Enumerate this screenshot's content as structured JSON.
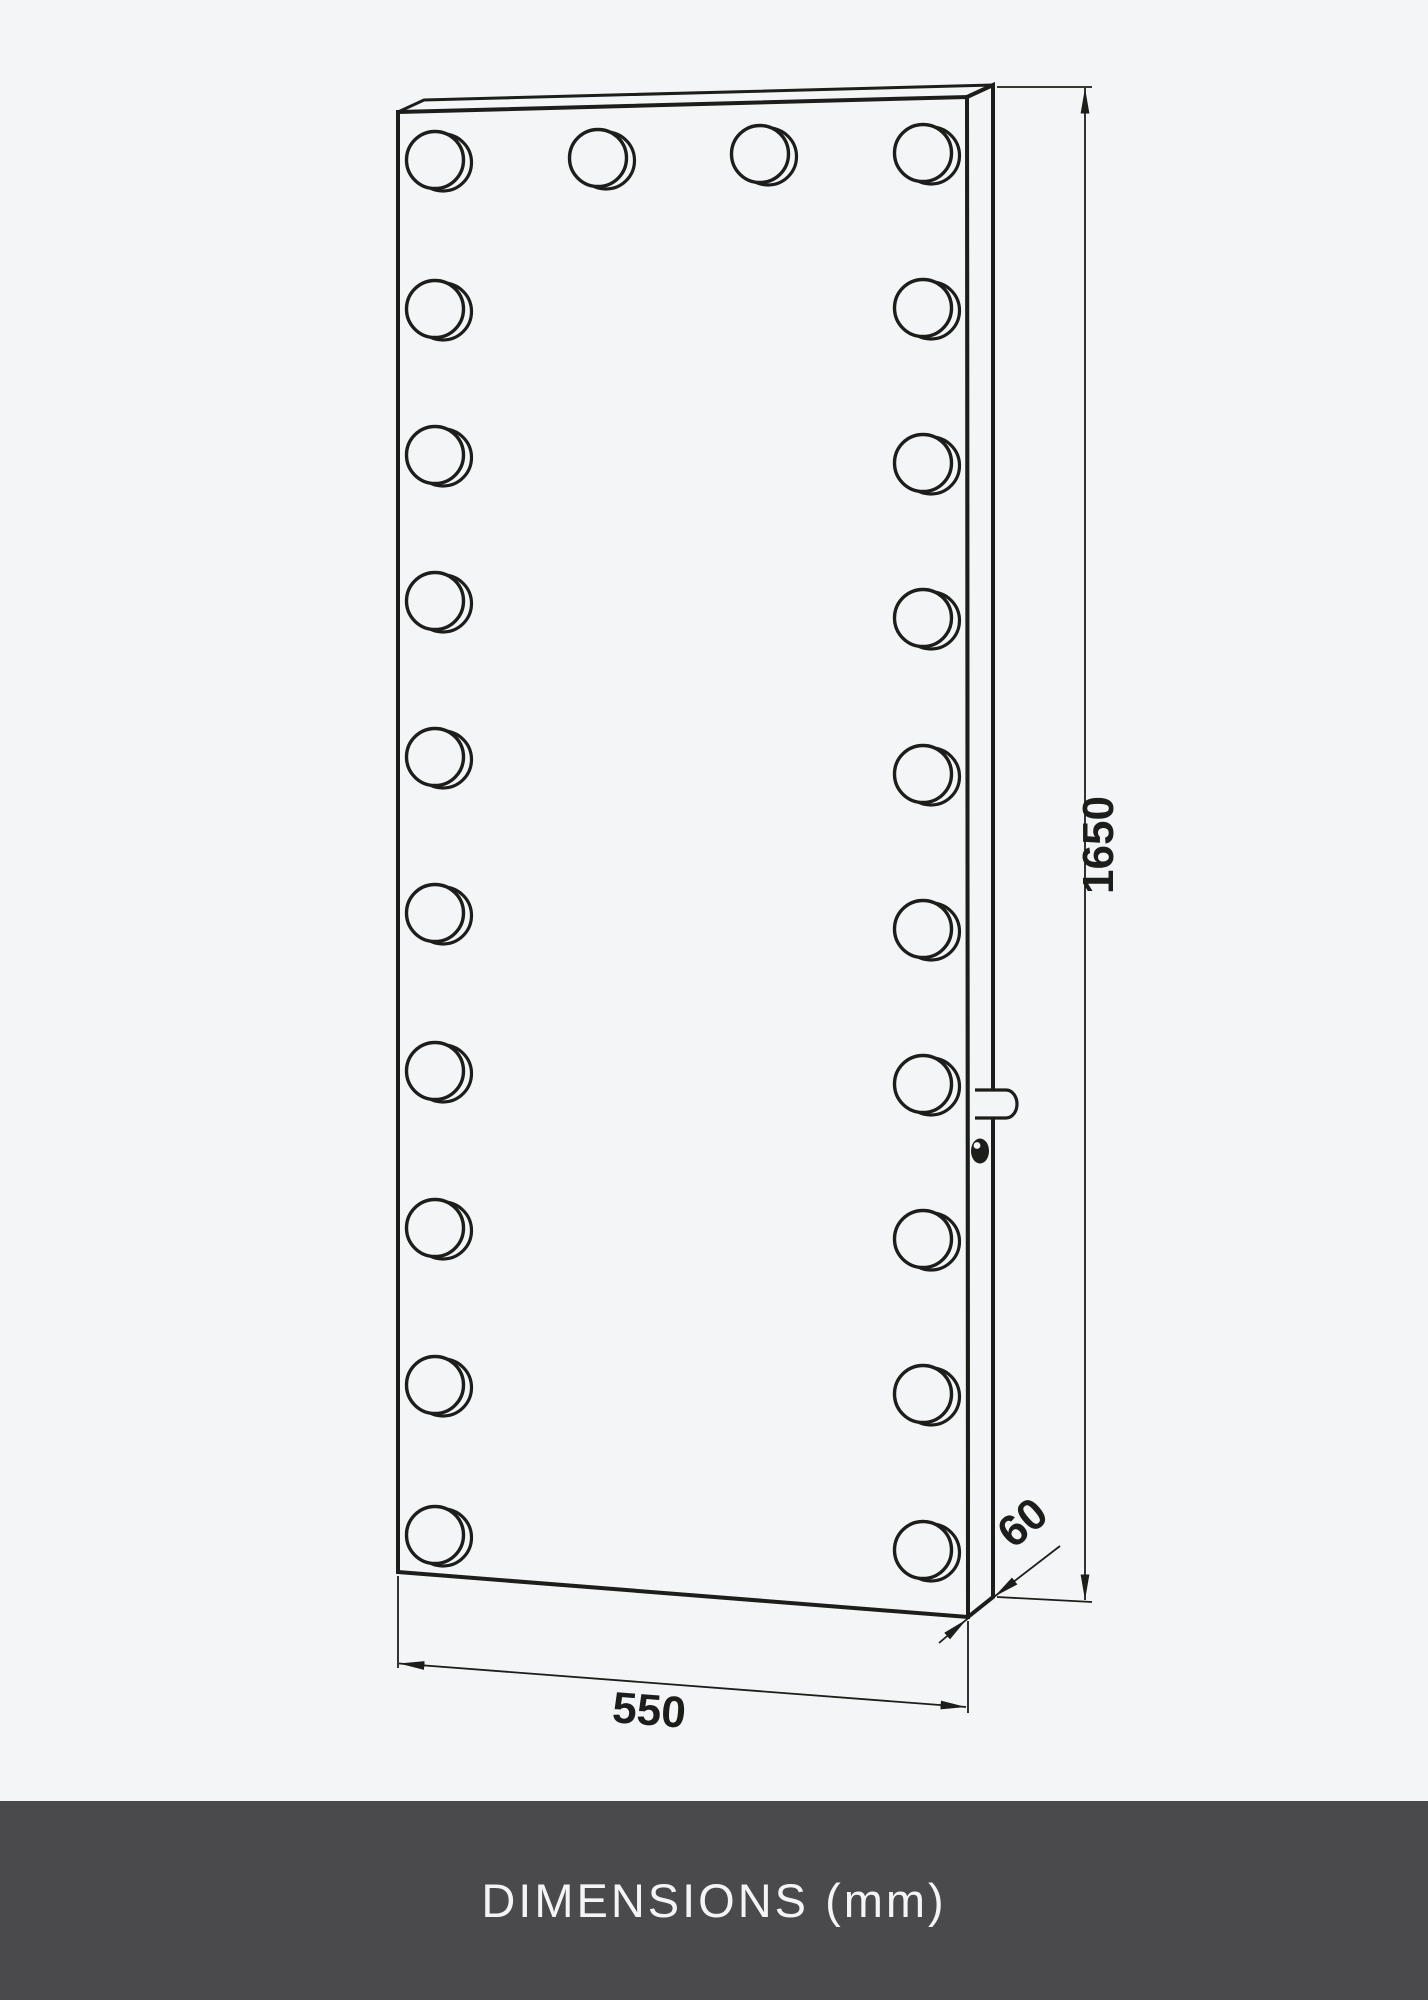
{
  "colors": {
    "background": "#f4f5f6",
    "line": "#1d1d1b",
    "footer_bg": "#4a4a4c",
    "footer_text": "#f4f4f6"
  },
  "diagram": {
    "height_label": "1650",
    "width_label": "550",
    "depth_label": "60",
    "bulbs": {
      "radius": 28.5,
      "offset_x": 8,
      "offset_y": 2.5,
      "top_row": [
        [
          598,
          158
        ],
        [
          760,
          154
        ]
      ],
      "left_column_x": 435,
      "left_column_y": [
        160,
        309,
        455,
        601,
        757,
        913,
        1071,
        1228,
        1385,
        1535
      ],
      "right_column_x": 923,
      "right_column_y": [
        153,
        308,
        463,
        618,
        774,
        929,
        1084,
        1239,
        1394,
        1550
      ]
    }
  },
  "footer": {
    "title": "DIMENSIONS (mm)"
  }
}
